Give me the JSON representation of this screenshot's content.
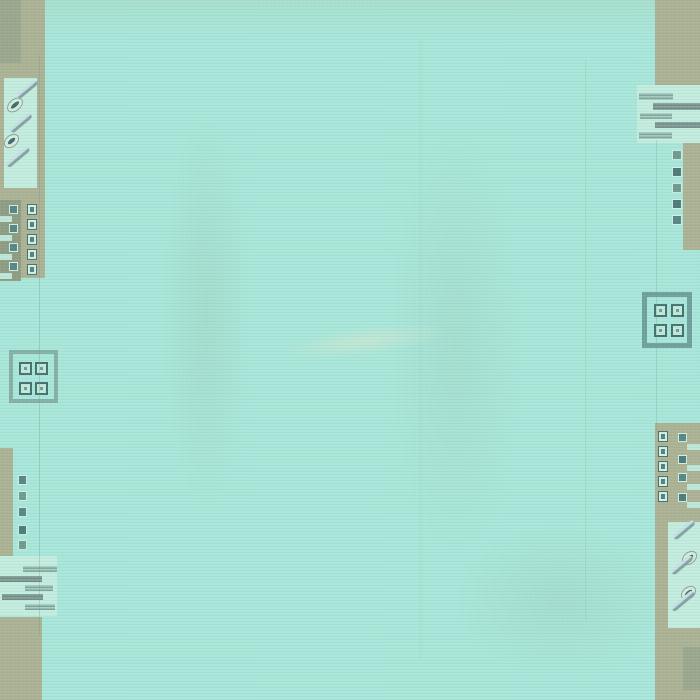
{
  "meta": {
    "description": "Photograph of a turquoise hand-woven wool rug. Plain aqua field with khaki/olive border blocks at the four corners and along parts of the left and right edges. Motifs: columns of small squares with dots, horizontal dashed bars, diagonal eye-and-slash marks, and two open square medallions each holding four dotted squares. No text anywhere in the image.",
    "width": 700,
    "height": 700
  },
  "palette": {
    "field_aqua": "#a8e6d9",
    "panel_light_aqua": "#c3ecdf",
    "border_khaki": "#acb294",
    "block_olive_gray": "#9aa78d",
    "block_dark_olive": "#8e9c82",
    "motif_teal": "#578684",
    "motif_teal_dark": "#44706f",
    "motif_light": "#d2efe4",
    "bar_gray_teal": "#8aa49d",
    "medallion_outline_left": "#85b0a8",
    "medallion_outline_right": "#6fa09c"
  },
  "shapes": [
    {
      "n": "field-top-tint",
      "x": 40,
      "y": -8,
      "w": 615,
      "h": 42,
      "bg": "linear-gradient(180deg, rgba(170,200,170,0.28), rgba(170,200,170,0))"
    },
    {
      "n": "field-shade-band-left",
      "x": 148,
      "y": 50,
      "w": 115,
      "h": 520,
      "bg": "radial-gradient(ellipse 50% 50% at 50% 50%, rgba(142,178,156,0.18), rgba(142,178,156,0) 75%)"
    },
    {
      "n": "field-shade-band-center",
      "x": 368,
      "y": 60,
      "w": 175,
      "h": 560,
      "bg": "radial-gradient(ellipse 50% 50% at 50% 50%, rgba(142,178,156,0.15), rgba(142,178,156,0) 75%)"
    },
    {
      "n": "field-sheen-streak",
      "x": 248,
      "y": 320,
      "w": 235,
      "h": 42,
      "rot": -7,
      "bg": "radial-gradient(ellipse 50% 50% at 50% 50%, rgba(218,230,206,0.55), rgba(218,230,206,0) 70%)"
    },
    {
      "n": "field-bottom-right-tint",
      "x": 420,
      "y": 500,
      "w": 280,
      "h": 200,
      "bg": "radial-gradient(ellipse 50% 50% at 50% 50%, rgba(130,172,150,0.14), rgba(130,172,150,0) 75%)"
    },
    {
      "n": "left-top-border-band",
      "x": 0,
      "y": 0,
      "w": 45,
      "h": 278,
      "bg": "#acb294"
    },
    {
      "n": "left-top-olive-rect",
      "x": 0,
      "y": 0,
      "w": 21,
      "h": 63,
      "bg": "#9aa78d"
    },
    {
      "n": "left-slash-panel",
      "x": 4,
      "y": 78,
      "w": 33,
      "h": 110,
      "bg": "#c3ecdf"
    },
    {
      "n": "slash-mark",
      "x": 15,
      "y": 86,
      "w": 25,
      "h": 6,
      "rot": -40,
      "r": "3px",
      "bg": "linear-gradient(180deg,#c6e0e6 0 45%,#84a5a0 55% 100%)"
    },
    {
      "n": "eye-mark",
      "x": 6,
      "y": 99,
      "w": 18,
      "h": 12,
      "rot": -40,
      "r": "50%",
      "bg": "#d4ece1",
      "bd": "1px solid #8fa392",
      "inner": {
        "inset": "3px",
        "bg": "#3d6c6c",
        "r": "50%"
      }
    },
    {
      "n": "slash-mark",
      "x": 8,
      "y": 120,
      "w": 26,
      "h": 6,
      "rot": -40,
      "r": "3px",
      "bg": "linear-gradient(180deg,#c6e0e6 0 45%,#84a5a0 55% 100%)"
    },
    {
      "n": "eye-mark",
      "x": 3,
      "y": 135,
      "w": 17,
      "h": 12,
      "rot": -40,
      "r": "50%",
      "bg": "#d4ece1",
      "bd": "1px solid #8fa392",
      "inner": {
        "inset": "3px",
        "bg": "#3d6c6c",
        "r": "50%"
      }
    },
    {
      "n": "slash-mark",
      "x": 4,
      "y": 154,
      "w": 28,
      "h": 6,
      "rot": -40,
      "r": "3px",
      "bg": "linear-gradient(180deg,#c6e0e6 0 45%,#84a5a0 55% 100%)"
    },
    {
      "n": "left-olive-block",
      "x": 0,
      "y": 200,
      "w": 21,
      "h": 81,
      "bg": "#8e9c82"
    },
    {
      "n": "teal-square",
      "x": 9,
      "y": 205,
      "w": 9,
      "h": 9,
      "bg": "#578684",
      "bd": "1px solid #cfeee4"
    },
    {
      "n": "teal-square",
      "x": 9,
      "y": 224,
      "w": 9,
      "h": 9,
      "bg": "#578684",
      "bd": "1px solid #cfeee4"
    },
    {
      "n": "teal-square",
      "x": 9,
      "y": 243,
      "w": 9,
      "h": 9,
      "bg": "#578684",
      "bd": "1px solid #cfeee4"
    },
    {
      "n": "teal-square",
      "x": 9,
      "y": 262,
      "w": 9,
      "h": 9,
      "bg": "#578684",
      "bd": "1px solid #cfeee4"
    },
    {
      "n": "light-bar",
      "x": 0,
      "y": 216,
      "w": 12,
      "h": 6,
      "bg": "#bde7d9"
    },
    {
      "n": "light-bar",
      "x": 0,
      "y": 235,
      "w": 12,
      "h": 6,
      "bg": "#bde7d9"
    },
    {
      "n": "light-bar",
      "x": 0,
      "y": 254,
      "w": 12,
      "h": 6,
      "bg": "#bde7d9"
    },
    {
      "n": "light-bar",
      "x": 0,
      "y": 273,
      "w": 12,
      "h": 6,
      "bg": "#bde7d9"
    },
    {
      "n": "dot-square",
      "x": 27,
      "y": 204,
      "w": 10,
      "h": 11,
      "bg": "#d2efe4",
      "bd": "1px solid #467372",
      "inner": {
        "inset": "2px",
        "bg": "#55807e"
      }
    },
    {
      "n": "dot-square",
      "x": 27,
      "y": 219,
      "w": 10,
      "h": 11,
      "bg": "#d2efe4",
      "bd": "1px solid #467372",
      "inner": {
        "inset": "2px",
        "bg": "#55807e"
      }
    },
    {
      "n": "dot-square",
      "x": 27,
      "y": 234,
      "w": 10,
      "h": 11,
      "bg": "#d2efe4",
      "bd": "1px solid #467372",
      "inner": {
        "inset": "2px",
        "bg": "#55807e"
      }
    },
    {
      "n": "dot-square",
      "x": 27,
      "y": 249,
      "w": 10,
      "h": 11,
      "bg": "#d2efe4",
      "bd": "1px solid #467372",
      "inner": {
        "inset": "2px",
        "bg": "#55807e"
      }
    },
    {
      "n": "dot-square",
      "x": 27,
      "y": 264,
      "w": 10,
      "h": 11,
      "bg": "#d2efe4",
      "bd": "1px solid #467372",
      "inner": {
        "inset": "2px",
        "bg": "#55807e"
      }
    },
    {
      "n": "left-medallion",
      "x": 9,
      "y": 350,
      "w": 49,
      "h": 53,
      "bg": "transparent",
      "bd": "4px solid #85b0a8"
    },
    {
      "n": "medallion-cell",
      "x": 19,
      "y": 362,
      "w": 13,
      "h": 13,
      "bg": "#c0e9dc",
      "bd": "2px solid #44706f",
      "inner": {
        "inset": "3px",
        "bg": "#6f9a94"
      }
    },
    {
      "n": "medallion-cell",
      "x": 35,
      "y": 362,
      "w": 13,
      "h": 13,
      "bg": "#c0e9dc",
      "bd": "2px solid #44706f",
      "inner": {
        "inset": "3px",
        "bg": "#6f9a94"
      }
    },
    {
      "n": "medallion-cell",
      "x": 19,
      "y": 382,
      "w": 13,
      "h": 13,
      "bg": "#c0e9dc",
      "bd": "2px solid #44706f",
      "inner": {
        "inset": "3px",
        "bg": "#6f9a94"
      }
    },
    {
      "n": "medallion-cell",
      "x": 35,
      "y": 382,
      "w": 13,
      "h": 13,
      "bg": "#c0e9dc",
      "bd": "2px solid #44706f",
      "inner": {
        "inset": "3px",
        "bg": "#6f9a94"
      }
    },
    {
      "n": "left-bottom-border-strip",
      "x": 0,
      "y": 448,
      "w": 13,
      "h": 112,
      "bg": "#acb294"
    },
    {
      "n": "teal-square",
      "x": 18,
      "y": 475,
      "w": 9,
      "h": 10,
      "bg": "#578684",
      "bd": "1px solid #cfeee4"
    },
    {
      "n": "teal-square",
      "x": 18,
      "y": 491,
      "w": 9,
      "h": 10,
      "bg": "#6f9a8e",
      "bd": "1px solid #cfeee4"
    },
    {
      "n": "teal-square",
      "x": 18,
      "y": 507,
      "w": 9,
      "h": 10,
      "bg": "#578684",
      "bd": "1px solid #cfeee4"
    },
    {
      "n": "teal-square",
      "x": 18,
      "y": 525,
      "w": 9,
      "h": 10,
      "bg": "#4c7b79",
      "bd": "1px solid #cfeee4"
    },
    {
      "n": "teal-square",
      "x": 18,
      "y": 540,
      "w": 9,
      "h": 10,
      "bg": "#6f9a8e",
      "bd": "1px solid #cfeee4"
    },
    {
      "n": "left-bars-panel",
      "x": 0,
      "y": 556,
      "w": 57,
      "h": 60,
      "bg": "#c3ecdf"
    },
    {
      "n": "dashed-bar",
      "x": 23,
      "y": 566,
      "w": 34,
      "h": 6,
      "bg": "repeating-linear-gradient(180deg,#a9cfc4 0 1.5px,#7fa49b 1.5px 3px)"
    },
    {
      "n": "dashed-bar",
      "x": 0,
      "y": 576,
      "w": 42,
      "h": 6,
      "bg": "repeating-linear-gradient(180deg,#8aa49d 0 1.5px,#6f8b85 1.5px 3px)"
    },
    {
      "n": "dashed-bar",
      "x": 25,
      "y": 585,
      "w": 28,
      "h": 6,
      "bg": "repeating-linear-gradient(180deg,#a9cfc4 0 1.5px,#7fa49b 1.5px 3px)"
    },
    {
      "n": "dashed-bar",
      "x": 2,
      "y": 594,
      "w": 41,
      "h": 6,
      "bg": "repeating-linear-gradient(180deg,#8aa49d 0 1.5px,#6f8b85 1.5px 3px)"
    },
    {
      "n": "dashed-bar",
      "x": 25,
      "y": 604,
      "w": 30,
      "h": 6,
      "bg": "repeating-linear-gradient(180deg,#a9cfc4 0 1.5px,#7fa49b 1.5px 3px)"
    },
    {
      "n": "left-bottom-corner-block",
      "x": 0,
      "y": 617,
      "w": 42,
      "h": 83,
      "bg": "#acb294"
    },
    {
      "n": "right-top-corner-block",
      "x": 655,
      "y": 0,
      "w": 45,
      "h": 86,
      "bg": "#acb294"
    },
    {
      "n": "right-bars-panel",
      "x": 637,
      "y": 85,
      "w": 63,
      "h": 58,
      "bg": "#c3ecdf"
    },
    {
      "n": "dashed-bar",
      "x": 639,
      "y": 93,
      "w": 34,
      "h": 7,
      "bg": "repeating-linear-gradient(180deg,#a9cfc4 0 1.5px,#7fa49b 1.5px 3px)"
    },
    {
      "n": "dashed-bar",
      "x": 653,
      "y": 103,
      "w": 47,
      "h": 7,
      "bg": "repeating-linear-gradient(180deg,#8aa49d 0 1.5px,#6f8b85 1.5px 3px)"
    },
    {
      "n": "dashed-bar",
      "x": 640,
      "y": 113,
      "w": 32,
      "h": 6,
      "bg": "repeating-linear-gradient(180deg,#a9cfc4 0 1.5px,#7fa49b 1.5px 3px)"
    },
    {
      "n": "dashed-bar",
      "x": 655,
      "y": 122,
      "w": 45,
      "h": 6,
      "bg": "repeating-linear-gradient(180deg,#8aa49d 0 1.5px,#6f8b85 1.5px 3px)"
    },
    {
      "n": "dashed-bar",
      "x": 639,
      "y": 132,
      "w": 33,
      "h": 7,
      "bg": "repeating-linear-gradient(180deg,#a9cfc4 0 1.5px,#7fa49b 1.5px 3px)"
    },
    {
      "n": "right-border-strip",
      "x": 683,
      "y": 143,
      "w": 17,
      "h": 107,
      "bg": "#acb294"
    },
    {
      "n": "teal-square",
      "x": 672,
      "y": 150,
      "w": 10,
      "h": 10,
      "bg": "#6f9a8e",
      "bd": "1px solid #cfeee4"
    },
    {
      "n": "teal-square",
      "x": 672,
      "y": 167,
      "w": 10,
      "h": 10,
      "bg": "#4c7b79",
      "bd": "1px solid #cfeee4"
    },
    {
      "n": "teal-square",
      "x": 672,
      "y": 183,
      "w": 10,
      "h": 10,
      "bg": "#6f9a8e",
      "bd": "1px solid #cfeee4"
    },
    {
      "n": "teal-square",
      "x": 672,
      "y": 199,
      "w": 10,
      "h": 10,
      "bg": "#4c7b79",
      "bd": "1px solid #cfeee4"
    },
    {
      "n": "teal-square",
      "x": 672,
      "y": 215,
      "w": 10,
      "h": 10,
      "bg": "#578684",
      "bd": "1px solid #cfeee4"
    },
    {
      "n": "right-medallion",
      "x": 642,
      "y": 292,
      "w": 50,
      "h": 56,
      "bg": "transparent",
      "bd": "5px solid #6fa09c"
    },
    {
      "n": "medallion-cell",
      "x": 654,
      "y": 304,
      "w": 13,
      "h": 13,
      "bg": "#c0e9dc",
      "bd": "2px solid #44706f",
      "inner": {
        "inset": "3px",
        "bg": "#6f9a94"
      }
    },
    {
      "n": "medallion-cell",
      "x": 671,
      "y": 304,
      "w": 13,
      "h": 13,
      "bg": "#c0e9dc",
      "bd": "2px solid #44706f",
      "inner": {
        "inset": "3px",
        "bg": "#6f9a94"
      }
    },
    {
      "n": "medallion-cell",
      "x": 654,
      "y": 324,
      "w": 13,
      "h": 13,
      "bg": "#c0e9dc",
      "bd": "2px solid #44706f",
      "inner": {
        "inset": "3px",
        "bg": "#6f9a94"
      }
    },
    {
      "n": "medallion-cell",
      "x": 671,
      "y": 324,
      "w": 13,
      "h": 13,
      "bg": "#c0e9dc",
      "bd": "2px solid #44706f",
      "inner": {
        "inset": "3px",
        "bg": "#6f9a94"
      }
    },
    {
      "n": "right-bottom-border-block",
      "x": 655,
      "y": 423,
      "w": 45,
      "h": 94,
      "bg": "#acb294"
    },
    {
      "n": "dot-square",
      "x": 658,
      "y": 431,
      "w": 10,
      "h": 11,
      "bg": "#d2efe4",
      "bd": "1px solid #467372",
      "inner": {
        "inset": "2px",
        "bg": "#55807e"
      }
    },
    {
      "n": "dot-square",
      "x": 658,
      "y": 446,
      "w": 10,
      "h": 11,
      "bg": "#d2efe4",
      "bd": "1px solid #467372",
      "inner": {
        "inset": "2px",
        "bg": "#55807e"
      }
    },
    {
      "n": "dot-square",
      "x": 658,
      "y": 461,
      "w": 10,
      "h": 11,
      "bg": "#d2efe4",
      "bd": "1px solid #467372",
      "inner": {
        "inset": "2px",
        "bg": "#55807e"
      }
    },
    {
      "n": "dot-square",
      "x": 658,
      "y": 476,
      "w": 10,
      "h": 11,
      "bg": "#d2efe4",
      "bd": "1px solid #467372",
      "inner": {
        "inset": "2px",
        "bg": "#55807e"
      }
    },
    {
      "n": "dot-square",
      "x": 658,
      "y": 491,
      "w": 10,
      "h": 11,
      "bg": "#d2efe4",
      "bd": "1px solid #467372",
      "inner": {
        "inset": "2px",
        "bg": "#55807e"
      }
    },
    {
      "n": "teal-square",
      "x": 678,
      "y": 433,
      "w": 9,
      "h": 9,
      "bg": "#578684",
      "bd": "1px solid #cfeee4"
    },
    {
      "n": "teal-square",
      "x": 678,
      "y": 455,
      "w": 9,
      "h": 9,
      "bg": "#4c7b79",
      "bd": "1px solid #cfeee4"
    },
    {
      "n": "teal-square",
      "x": 678,
      "y": 473,
      "w": 9,
      "h": 9,
      "bg": "#578684",
      "bd": "1px solid #cfeee4"
    },
    {
      "n": "teal-square",
      "x": 678,
      "y": 493,
      "w": 9,
      "h": 9,
      "bg": "#4c7b79",
      "bd": "1px solid #cfeee4"
    },
    {
      "n": "light-bar",
      "x": 687,
      "y": 444,
      "w": 13,
      "h": 6,
      "bg": "#bde7d9"
    },
    {
      "n": "light-bar",
      "x": 687,
      "y": 465,
      "w": 13,
      "h": 6,
      "bg": "#bde7d9"
    },
    {
      "n": "light-bar",
      "x": 687,
      "y": 484,
      "w": 13,
      "h": 6,
      "bg": "#bde7d9"
    },
    {
      "n": "light-bar",
      "x": 687,
      "y": 502,
      "w": 13,
      "h": 6,
      "bg": "#bde7d9"
    },
    {
      "n": "right-bottom-corner-block",
      "x": 655,
      "y": 517,
      "w": 45,
      "h": 183,
      "bg": "#acb294"
    },
    {
      "n": "right-slash-panel",
      "x": 668,
      "y": 522,
      "w": 32,
      "h": 106,
      "bg": "#c3ecdf"
    },
    {
      "n": "slash-mark",
      "x": 671,
      "y": 527,
      "w": 26,
      "h": 6,
      "rot": -40,
      "r": "3px",
      "bg": "linear-gradient(180deg,#c6e0e6 0 45%,#84a5a0 55% 100%)"
    },
    {
      "n": "eye-mark",
      "x": 681,
      "y": 552,
      "w": 17,
      "h": 12,
      "rot": -40,
      "r": "50%",
      "bg": "#d4ece1",
      "bd": "1px solid #8fa392",
      "inner": {
        "inset": "3px",
        "bg": "#3d6c6c",
        "r": "50%"
      }
    },
    {
      "n": "slash-mark",
      "x": 669,
      "y": 562,
      "w": 26,
      "h": 6,
      "rot": -40,
      "r": "3px",
      "bg": "linear-gradient(180deg,#c6e0e6 0 45%,#84a5a0 55% 100%)"
    },
    {
      "n": "eye-mark",
      "x": 680,
      "y": 587,
      "w": 17,
      "h": 12,
      "rot": -40,
      "r": "50%",
      "bg": "#d4ece1",
      "bd": "1px solid #8fa392",
      "inner": {
        "inset": "3px",
        "bg": "#3d6c6c",
        "r": "50%"
      }
    },
    {
      "n": "slash-mark",
      "x": 669,
      "y": 598,
      "w": 28,
      "h": 6,
      "rot": -40,
      "r": "3px",
      "bg": "linear-gradient(180deg,#c6e0e6 0 45%,#84a5a0 55% 100%)"
    },
    {
      "n": "right-bottom-olive-rect",
      "x": 683,
      "y": 647,
      "w": 17,
      "h": 43,
      "bg": "#9aa78d"
    },
    {
      "n": "seam-line-left",
      "x": 39,
      "y": 55,
      "w": 1,
      "h": 580,
      "bg": "rgba(105,150,138,0.30)"
    },
    {
      "n": "seam-line-right",
      "x": 656,
      "y": 140,
      "w": 1,
      "h": 292,
      "bg": "rgba(105,150,138,0.28)"
    },
    {
      "n": "warp-crease-right",
      "x": 585,
      "y": 60,
      "w": 1,
      "h": 560,
      "bg": "rgba(120,160,148,0.16)"
    },
    {
      "n": "warp-crease-center",
      "x": 420,
      "y": 40,
      "w": 1,
      "h": 620,
      "bg": "rgba(120,160,148,0.12)"
    }
  ]
}
